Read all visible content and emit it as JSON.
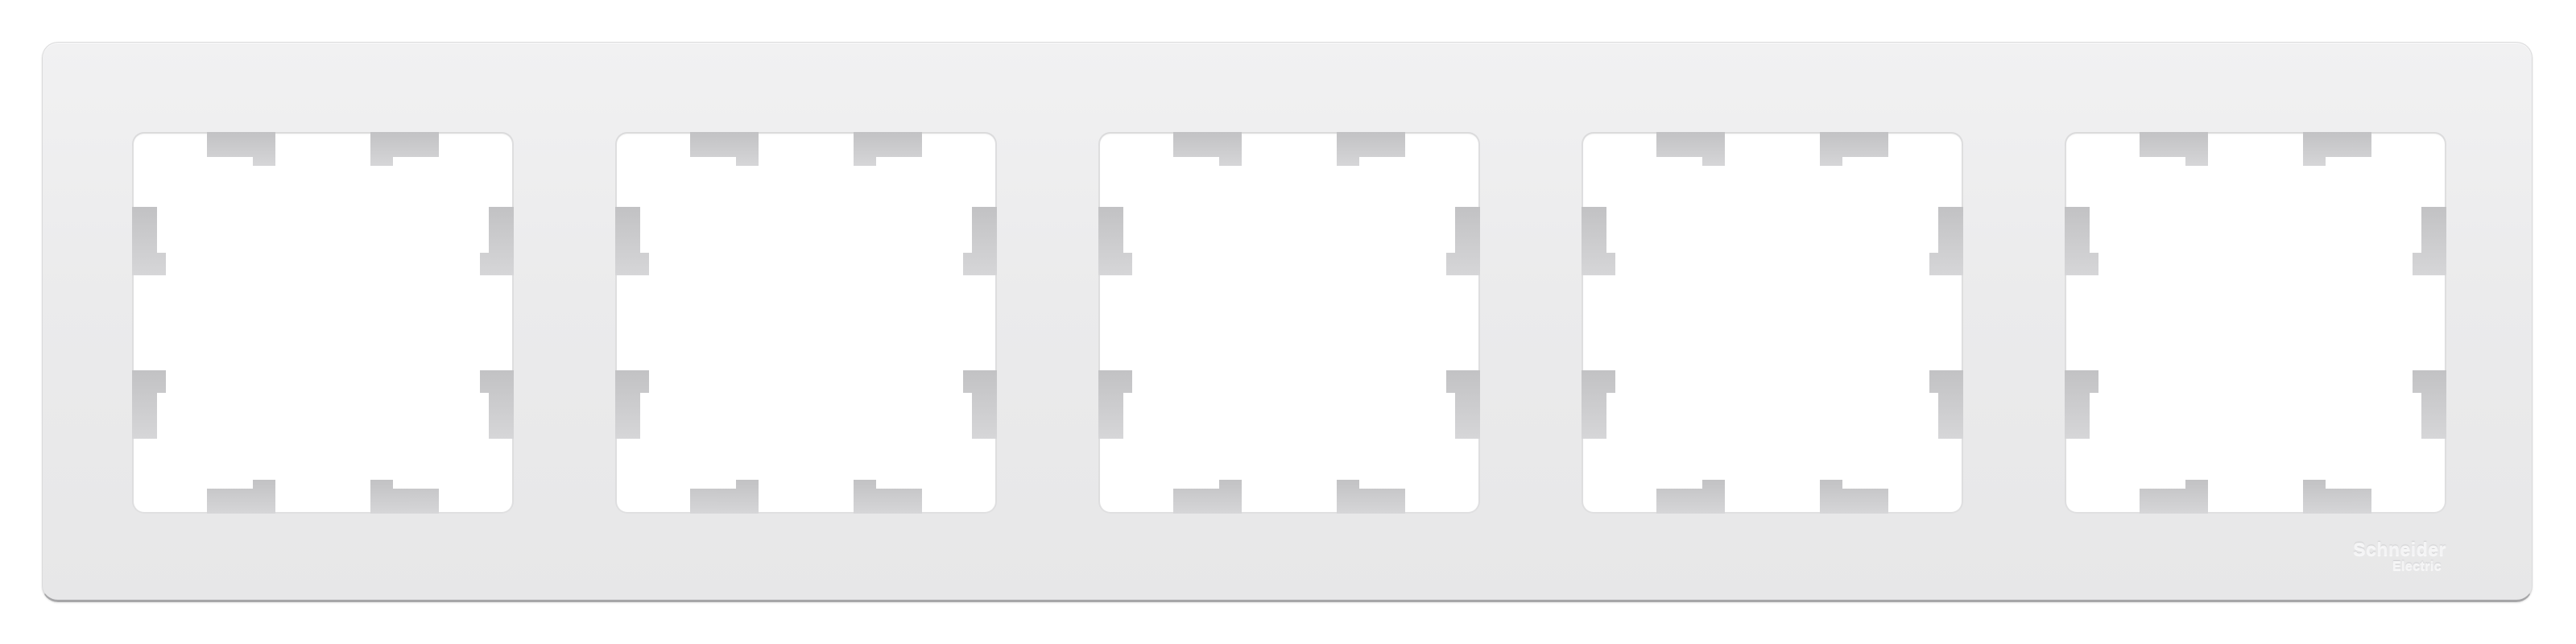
{
  "product": {
    "description": "White 5-gang wall plate frame with five square module openings, each opening has eight gray mounting tabs",
    "gangs": 5,
    "tabs_per_opening": 8,
    "brand_logo": {
      "line1": "Schneider",
      "line2": "Electric"
    }
  },
  "colors": {
    "page_background": "#ffffff",
    "frame_fill": "#ebebec",
    "frame_fill_light": "#f1f1f2",
    "frame_fill_dark": "#e7e7e8",
    "frame_border": "#dadadb",
    "frame_bottom_edge": "#a6a6a8",
    "opening_fill": "#ffffff",
    "opening_edge": "#c7c7c9",
    "tab_gradient_start": "#c2c2c4",
    "tab_gradient_end": "#d6d6d8",
    "logo_text": "#f4f4f5"
  }
}
